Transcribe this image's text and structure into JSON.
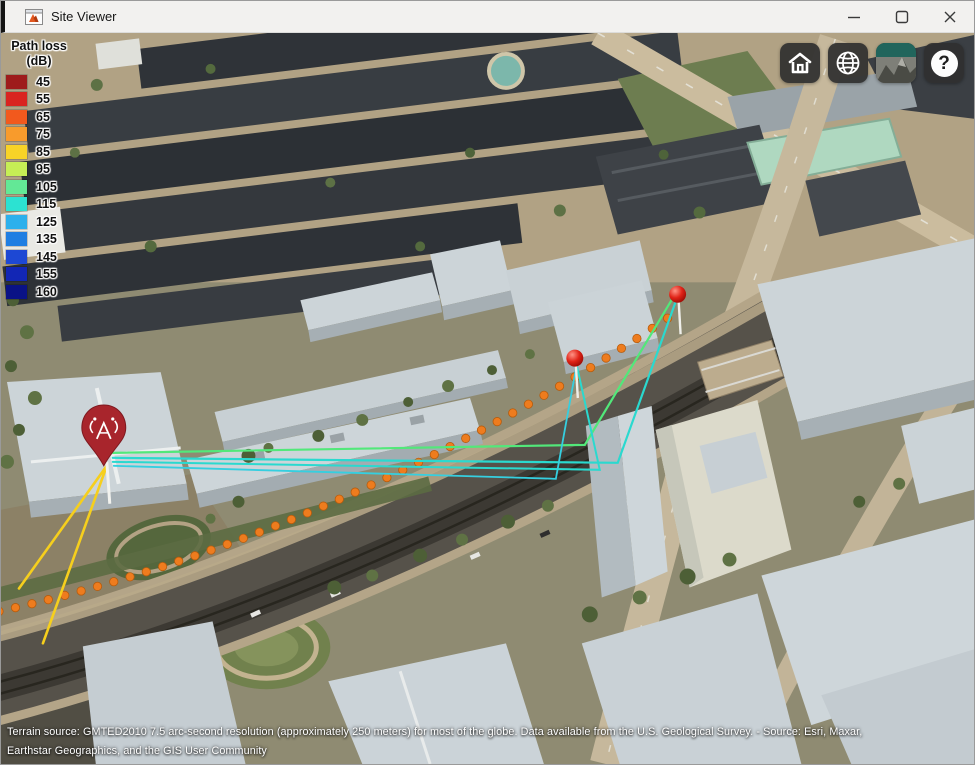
{
  "window": {
    "title": "Site Viewer"
  },
  "legend": {
    "title_line1": "Path loss",
    "title_line2": "(dB)",
    "entries": [
      {
        "value": "45",
        "color": "#9e1b1b"
      },
      {
        "value": "55",
        "color": "#d92420"
      },
      {
        "value": "65",
        "color": "#f2591d"
      },
      {
        "value": "75",
        "color": "#f89b2c"
      },
      {
        "value": "85",
        "color": "#f8d327"
      },
      {
        "value": "95",
        "color": "#c6ee55"
      },
      {
        "value": "105",
        "color": "#63e896"
      },
      {
        "value": "115",
        "color": "#2ce2d2"
      },
      {
        "value": "125",
        "color": "#2cb0ec"
      },
      {
        "value": "135",
        "color": "#1f7ee2"
      },
      {
        "value": "145",
        "color": "#1d48d4"
      },
      {
        "value": "155",
        "color": "#1226b5"
      },
      {
        "value": "160",
        "color": "#0a1286"
      }
    ]
  },
  "toolbar": {
    "help_glyph": "?"
  },
  "attribution": {
    "line1": "Terrain source: GMTED2010 7.5 arc-second resolution (approximately 250 meters) for most of the globe. Data available from the U.S. Geological Survey. - Source: Esri, Maxar,",
    "line2": "Earthstar Geographics, and the GIS User Community"
  },
  "scene": {
    "rays": [
      {
        "color": "#52e87a",
        "width": 2.2,
        "points": [
          [
            112,
            421
          ],
          [
            585,
            413
          ],
          [
            676,
            261
          ]
        ]
      },
      {
        "color": "#2ad9cf",
        "width": 2.2,
        "points": [
          [
            112,
            426
          ],
          [
            618,
            431
          ],
          [
            678,
            264
          ]
        ]
      },
      {
        "color": "#2ad9cf",
        "width": 2.0,
        "points": [
          [
            112,
            430
          ],
          [
            600,
            438
          ],
          [
            576,
            329
          ]
        ]
      },
      {
        "color": "#35cfe0",
        "width": 1.8,
        "points": [
          [
            113,
            434
          ],
          [
            556,
            447
          ],
          [
            577,
            332
          ]
        ]
      },
      {
        "color": "#f6cf1d",
        "width": 2.6,
        "points": [
          [
            106,
            434
          ],
          [
            18,
            557
          ]
        ]
      },
      {
        "color": "#f6cf1d",
        "width": 2.6,
        "points": [
          [
            106,
            434
          ],
          [
            42,
            612
          ]
        ]
      }
    ],
    "route": {
      "color": "#ee7c1e",
      "edge": "#b65c0d",
      "radius": 4.2,
      "count": 43,
      "from": [
        -2,
        580
      ],
      "ctrl": [
        345,
        502
      ],
      "to": [
        668,
        286
      ]
    },
    "transmitter": {
      "x": 103,
      "y": 400
    },
    "receivers": [
      {
        "x": 575,
        "y": 326
      },
      {
        "x": 678,
        "y": 262
      }
    ]
  }
}
